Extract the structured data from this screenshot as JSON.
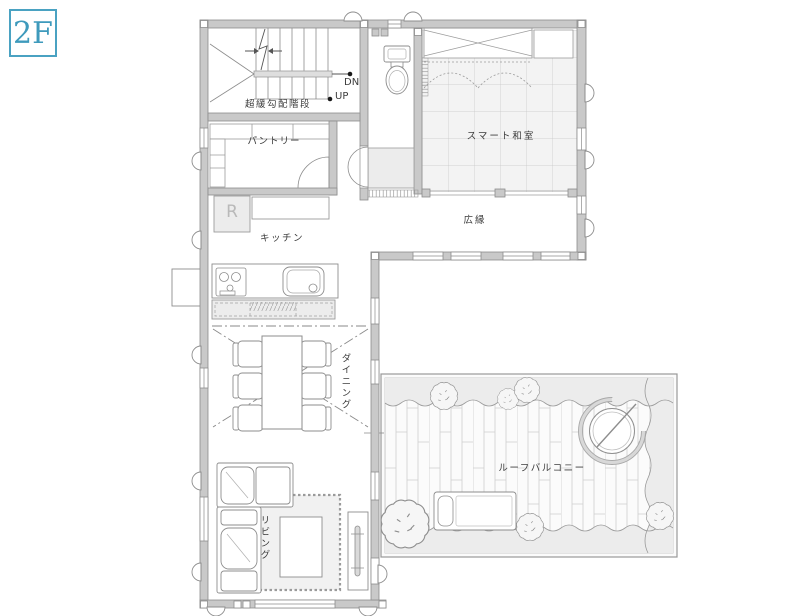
{
  "floor_label": "2F",
  "colors": {
    "accent": "#3e9abc",
    "wall_fill": "#c9c9c9",
    "wall_outline": "#8d8d8d",
    "label_text": "#3c3c3c"
  },
  "rooms": {
    "stairs": {
      "label": "超緩勾配階段",
      "down_label": "DN",
      "up_label": "UP"
    },
    "pantry": {
      "label": "パントリー"
    },
    "refrigerator": {
      "label": "R"
    },
    "kitchen": {
      "label": "キッチン"
    },
    "japanese_room": {
      "label": "スマート和室"
    },
    "veranda": {
      "label": "広縁"
    },
    "dining": {
      "label": "ダイニング"
    },
    "living": {
      "label": "リビング"
    },
    "roof_balcony": {
      "label": "ルーフバルコニー"
    }
  }
}
